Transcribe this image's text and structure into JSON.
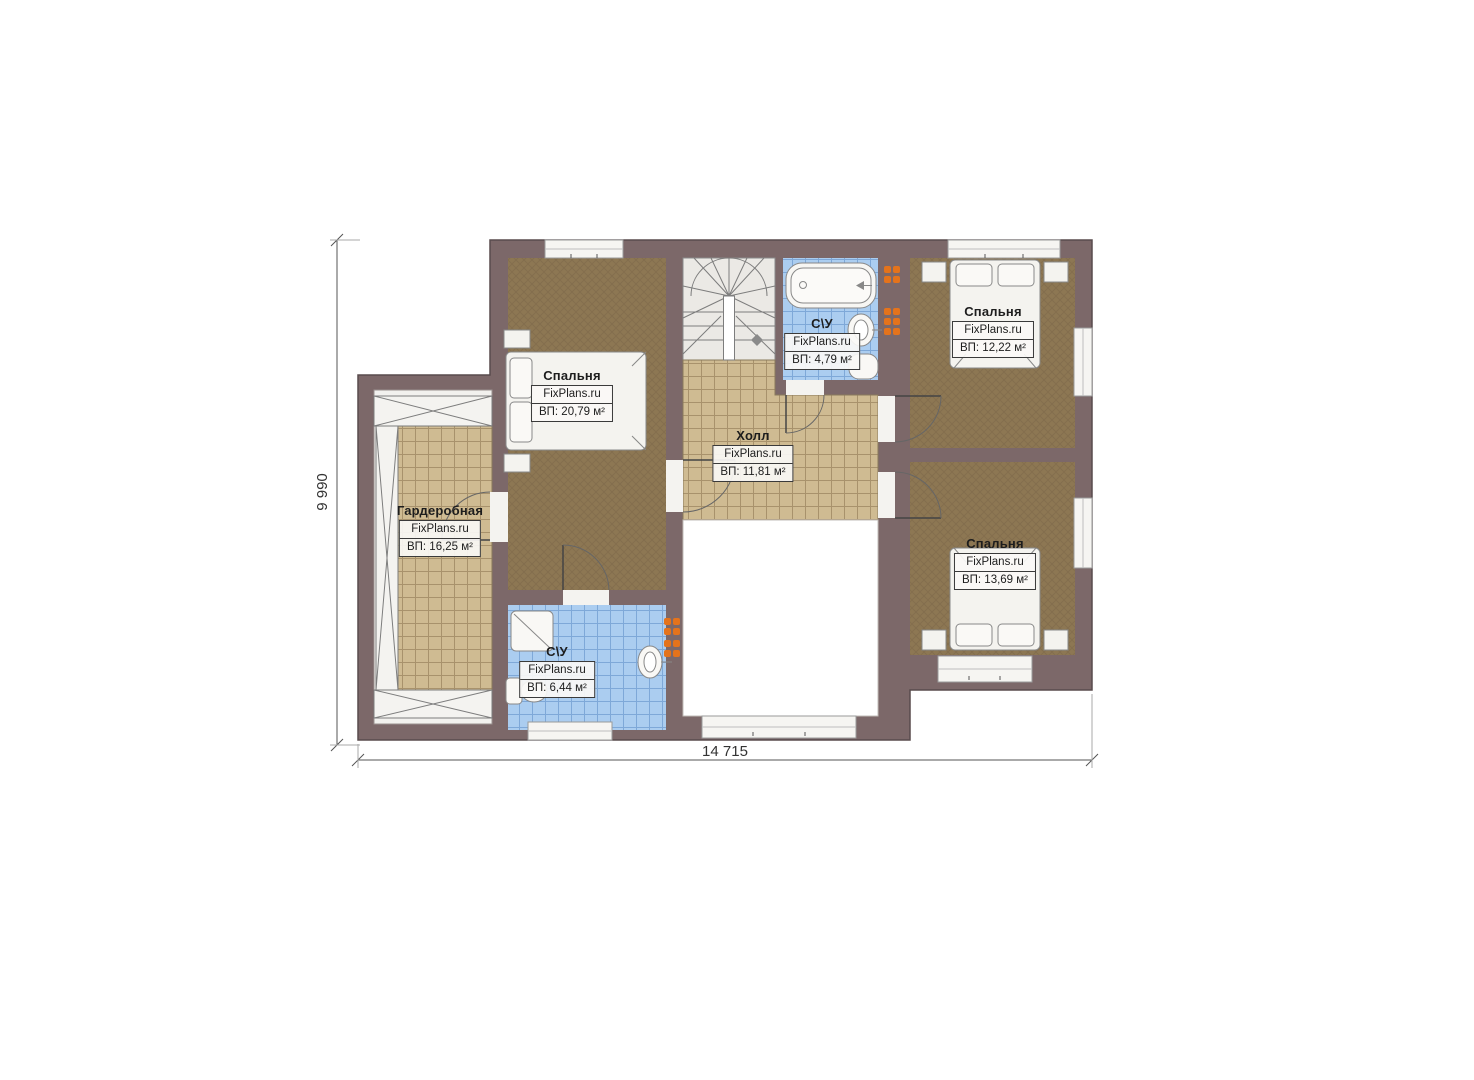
{
  "plan": {
    "type": "floor-plan",
    "brand": "FixPlans.ru",
    "dimensions": {
      "width": "14 715",
      "height": "9 990"
    },
    "rooms": [
      {
        "id": "bedroom-left",
        "name": "Спальня",
        "brand": "FixPlans.ru",
        "area": "ВП: 20,79 м²"
      },
      {
        "id": "hall",
        "name": "Холл",
        "brand": "FixPlans.ru",
        "area": "ВП: 11,81 м²"
      },
      {
        "id": "bathroom-top",
        "name": "С\\У",
        "brand": "FixPlans.ru",
        "area": "ВП: 4,79 м²"
      },
      {
        "id": "bedroom-top-right",
        "name": "Спальня",
        "brand": "FixPlans.ru",
        "area": "ВП: 12,22 м²"
      },
      {
        "id": "bedroom-bottom-right",
        "name": "Спальня",
        "brand": "FixPlans.ru",
        "area": "ВП: 13,69 м²"
      },
      {
        "id": "wardrobe",
        "name": "Гардеробная",
        "brand": "FixPlans.ru",
        "area": "ВП: 16,25 м²"
      },
      {
        "id": "bathroom-bottom",
        "name": "С\\У",
        "brand": "FixPlans.ru",
        "area": "ВП: 6,44 м²"
      }
    ],
    "colors": {
      "wall": "#7c6869",
      "wall_edge": "#584b4d",
      "floor_wood": "#8d7753",
      "tile_tan": "#cfbb92",
      "tile_tan_line": "#a8926c",
      "tile_blue": "#abcdf0",
      "tile_blue_line": "#7ea8d8",
      "fixture": "#f2f1ee",
      "radiator": "#e4731c",
      "dimension_text": "#333333"
    }
  }
}
